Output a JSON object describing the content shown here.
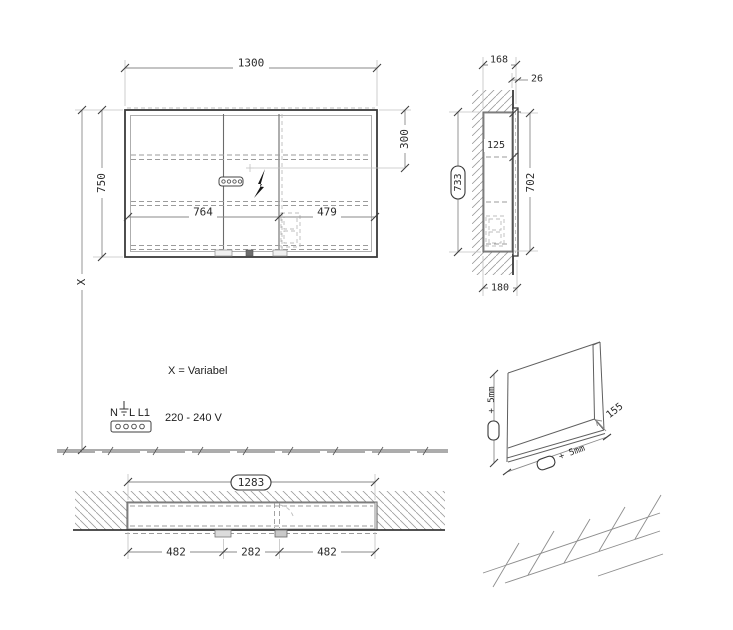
{
  "drawing_type": "mirror-cabinet installation drawing",
  "colors": {
    "line": "#3a3a3a",
    "extension": "#c2c2c2",
    "hidden": "#9b9b9b",
    "background": "#ffffff"
  },
  "front": {
    "width": "1300",
    "height": "750",
    "left_section": "764",
    "right_section": "479",
    "socket_drop": "300",
    "variable_height": "X"
  },
  "side": {
    "depth_total": "168",
    "protrusion": "26",
    "top_offset": "125",
    "niche_height_framed": "733",
    "body_height": "702",
    "bottom_depth": "180"
  },
  "bottom": {
    "niche_width_framed": "1283",
    "left_section": "482",
    "middle_section": "282",
    "right_section": "482"
  },
  "niche": {
    "height_tolerance": "+ 5mm",
    "width_tolerance": "+ 5mm",
    "depth": "155"
  },
  "electrical": {
    "note_variable": "X = Variabel",
    "terminal_n": "N",
    "terminal_l": "L L1",
    "voltage": "220 - 240 V"
  }
}
